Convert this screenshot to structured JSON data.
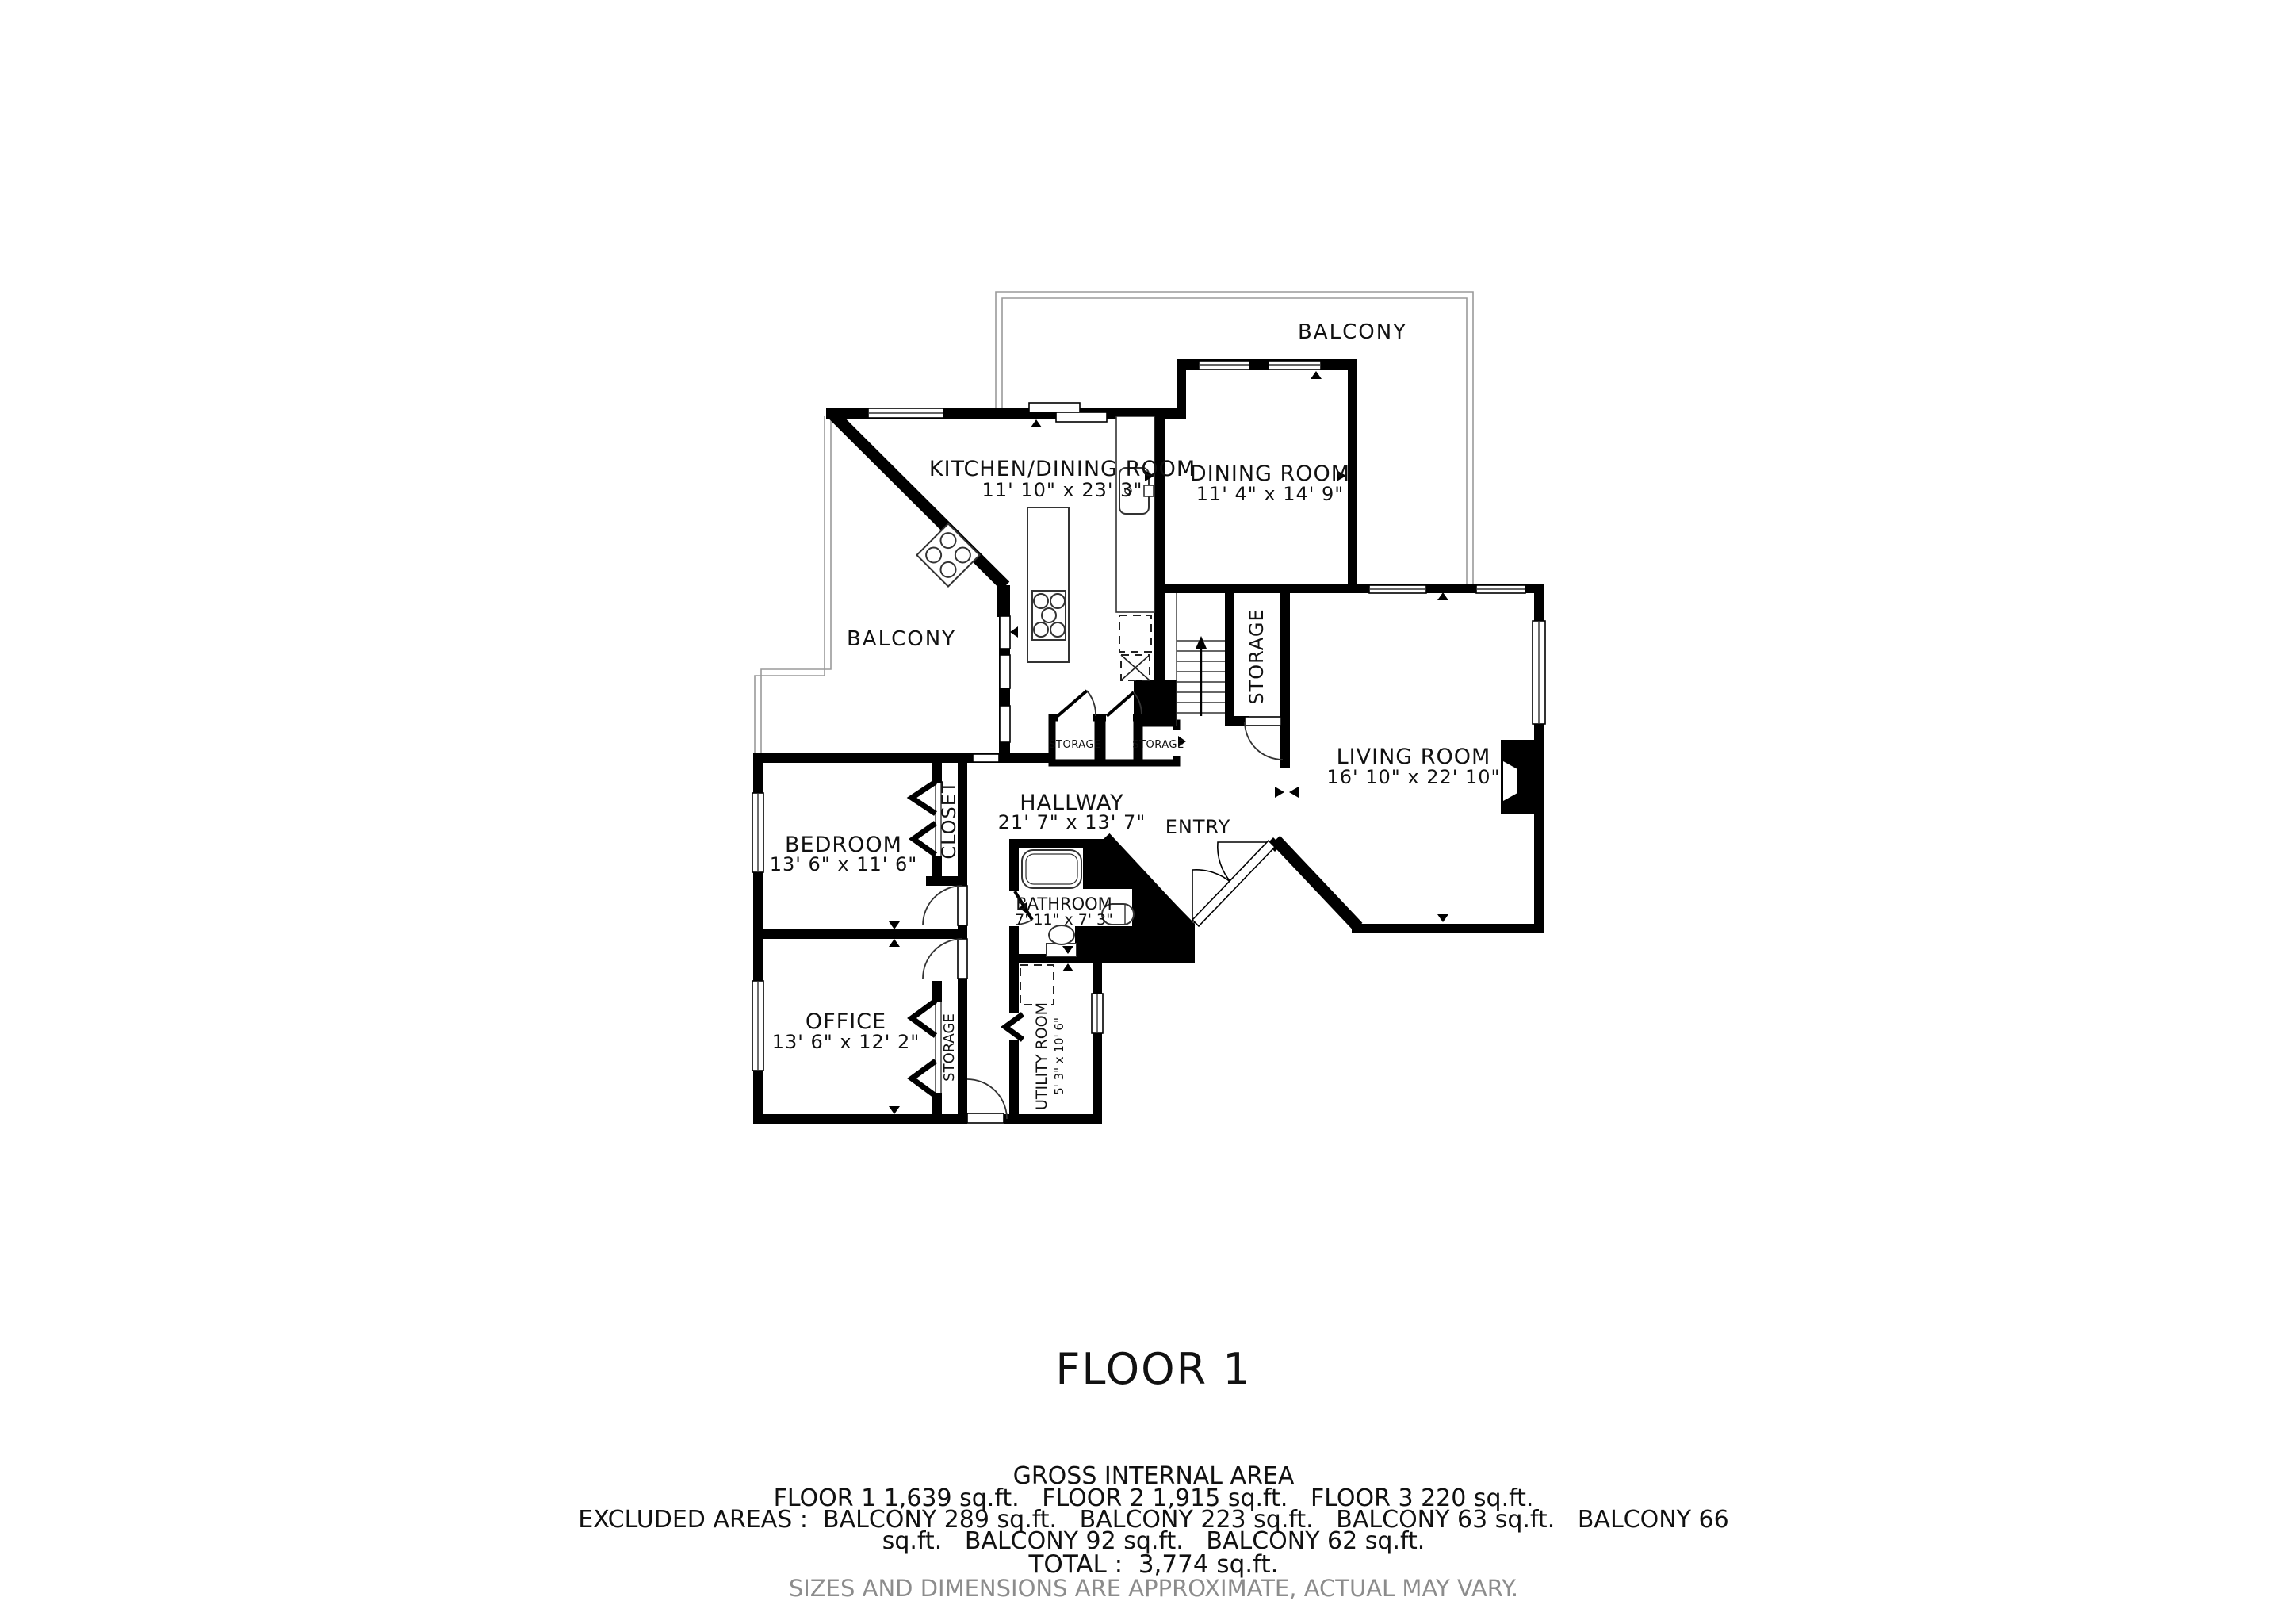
{
  "plan": {
    "floor_title": "FLOOR 1",
    "rooms": {
      "kitchen_dining": {
        "name": "KITCHEN/DINING ROOM",
        "dims": "11' 10\" x 23' 3\""
      },
      "dining": {
        "name": "DINING ROOM",
        "dims": "11' 4\" x 14' 9\""
      },
      "living": {
        "name": "LIVING ROOM",
        "dims": "16' 10\" x 22' 10\""
      },
      "hallway": {
        "name": "HALLWAY",
        "dims": "21' 7\" x 13' 7\""
      },
      "entry": {
        "name": "ENTRY"
      },
      "bedroom": {
        "name": "BEDROOM",
        "dims": "13' 6\" x 11' 6\""
      },
      "bathroom": {
        "name": "BATHROOM",
        "dims": "7' 11\" x 7' 3\""
      },
      "office": {
        "name": "OFFICE",
        "dims": "13' 6\" x 12' 2\""
      },
      "utility": {
        "name": "UTILITY ROOM",
        "dims": "5' 3\" x 10' 6\""
      },
      "closet": {
        "name": "CLOSET"
      },
      "storage": {
        "name": "STORAGE"
      },
      "balcony": {
        "name": "BALCONY"
      }
    },
    "summary": {
      "gross_title": "GROSS INTERNAL AREA",
      "floors_line": "FLOOR 1 1,639 sq.ft.   FLOOR 2 1,915 sq.ft.   FLOOR 3 220 sq.ft.",
      "excluded_line1": "EXCLUDED AREAS :  BALCONY 289 sq.ft.   BALCONY 223 sq.ft.   BALCONY 63 sq.ft.   BALCONY 66",
      "excluded_line2": "sq.ft.   BALCONY 92 sq.ft.   BALCONY 62 sq.ft.",
      "total_line": "TOTAL :  3,774 sq.ft."
    },
    "note": "SIZES AND DIMENSIONS ARE APPROXIMATE, ACTUAL MAY VARY.",
    "colors": {
      "wall": "#000000",
      "balcony_line": "#9a9a9a",
      "note_text": "#8c8c8c"
    }
  }
}
